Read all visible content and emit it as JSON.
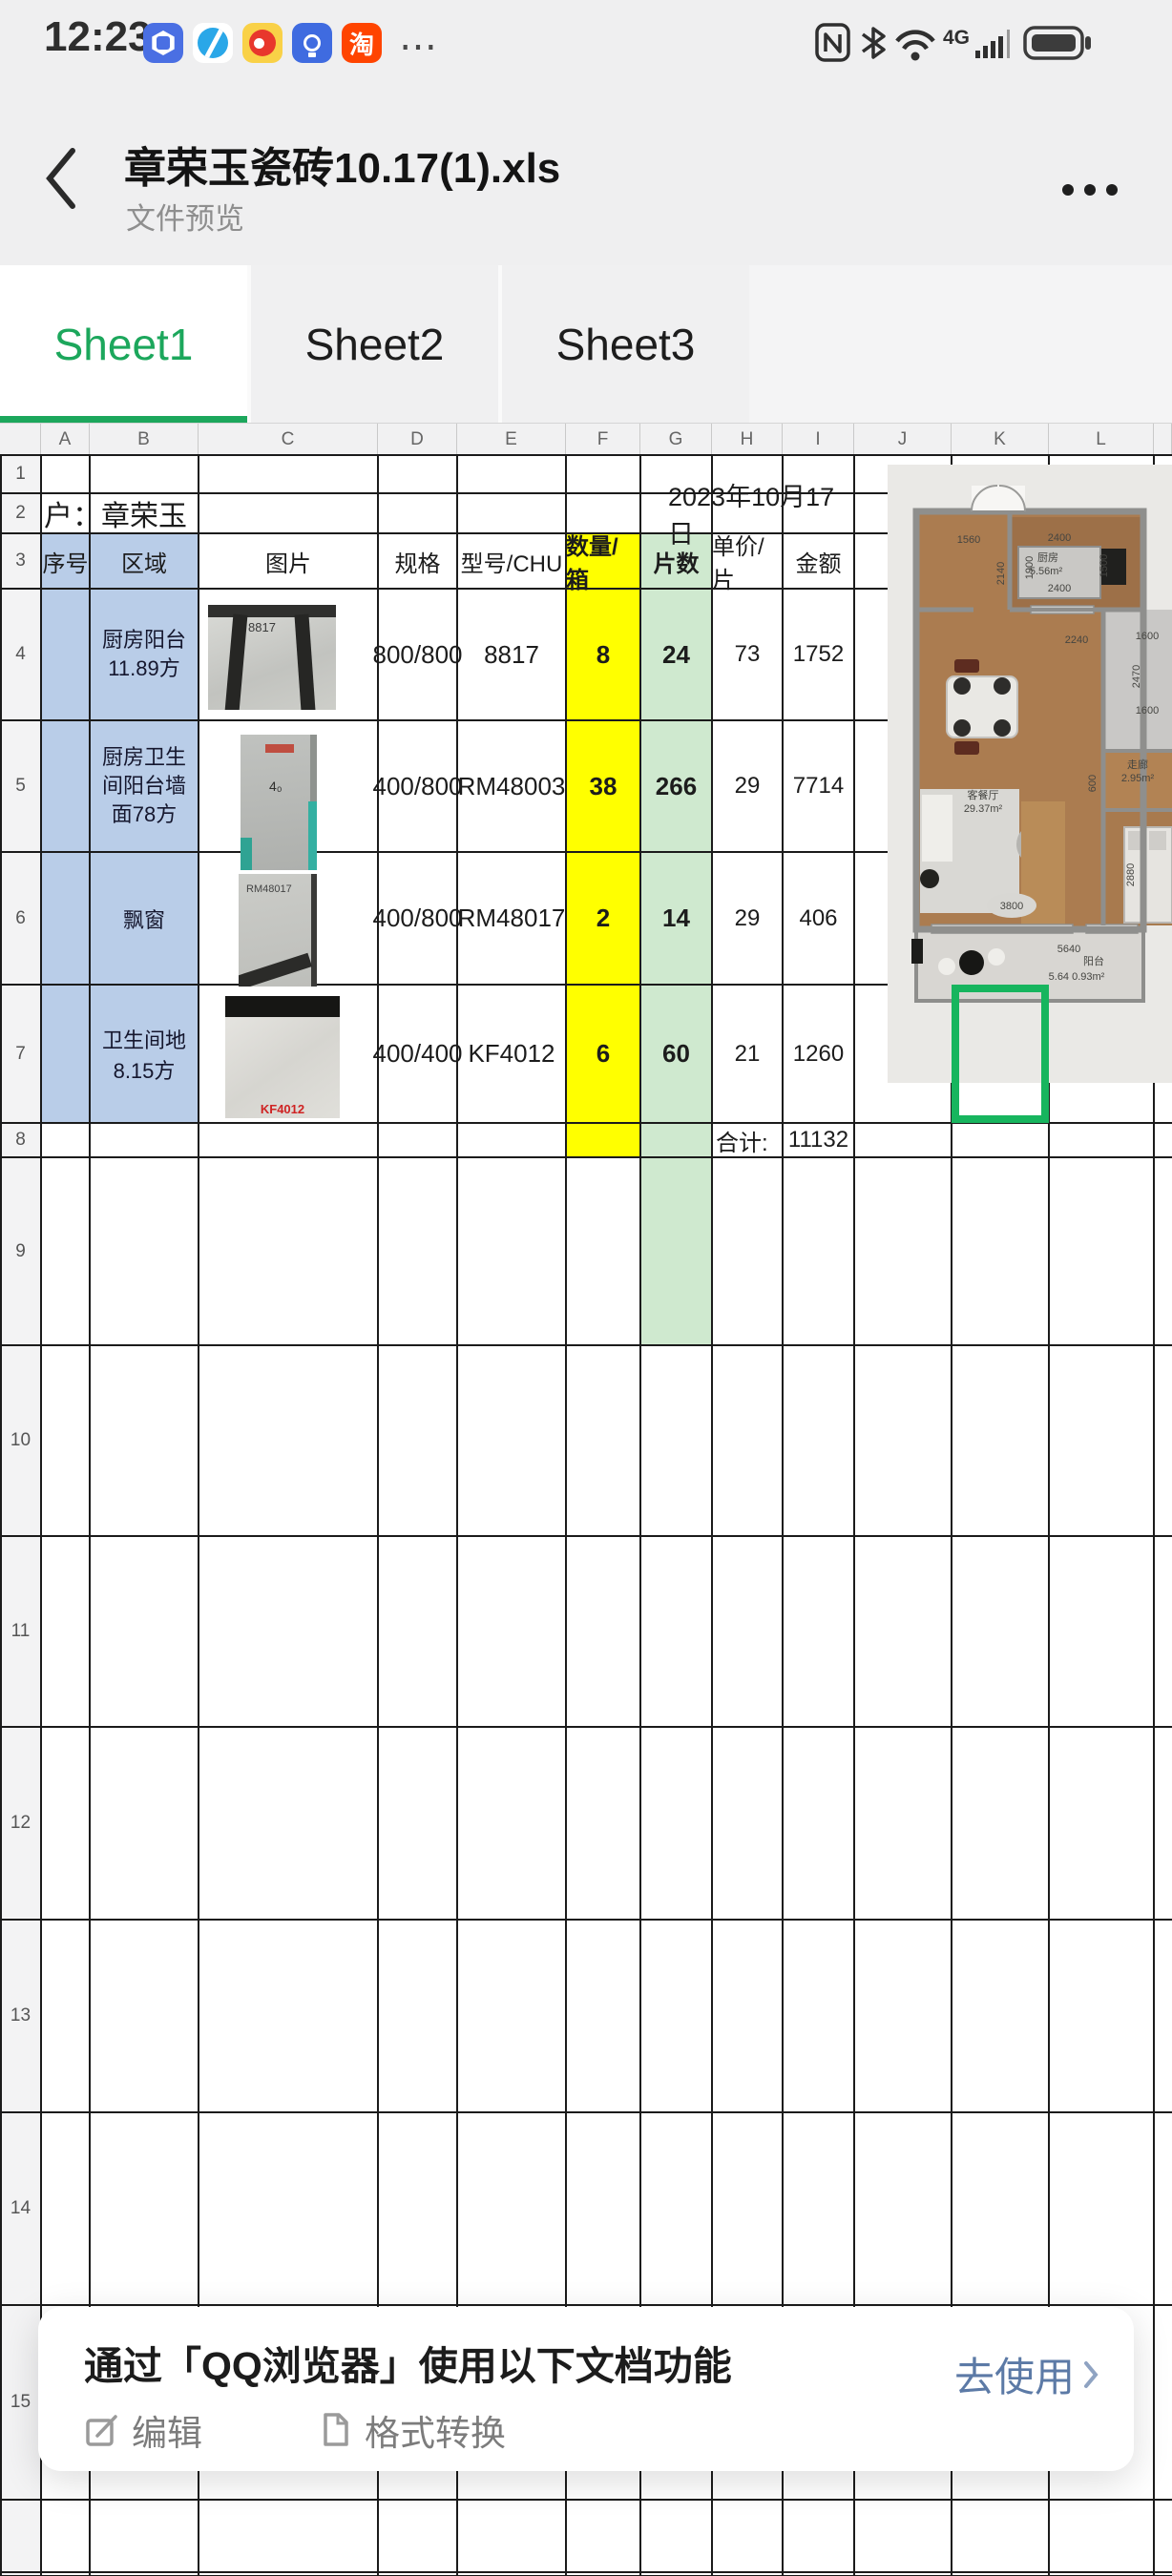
{
  "status_bar": {
    "time": "12:23",
    "more_indicator": "⋯",
    "icons": [
      "hand-app-icon",
      "globe-app-icon",
      "weibo-app-icon",
      "lightbulb-app-icon",
      "taobao-app-icon"
    ],
    "taobao_char": "淘",
    "network_label": "4G"
  },
  "nav": {
    "title": "章荣玉瓷砖10.17(1).xls",
    "subtitle": "文件预览"
  },
  "tabs": [
    {
      "label": "Sheet1",
      "active": true
    },
    {
      "label": "Sheet2",
      "active": false
    },
    {
      "label": "Sheet3",
      "active": false
    }
  ],
  "sheet": {
    "columns": [
      "A",
      "B",
      "C",
      "D",
      "E",
      "F",
      "G",
      "H",
      "I",
      "J",
      "K",
      "L"
    ],
    "row_numbers": [
      "1",
      "2",
      "3",
      "4",
      "5",
      "6",
      "7",
      "8",
      "9",
      "10",
      "11",
      "12",
      "13",
      "14",
      "15"
    ],
    "customer": "户：章荣玉",
    "date": "2023年10月17日",
    "header": {
      "seq": "序号",
      "area": "区域",
      "image": "图片",
      "spec": "规格",
      "model": "型号/CHU",
      "boxes": "数量/箱",
      "pieces": "片数",
      "unit_price": "单价/片",
      "amount": "金额"
    },
    "rows": [
      {
        "area": "厨房阳台11.89方",
        "spec": "800/800",
        "model": "8817",
        "boxes": "8",
        "pieces": "24",
        "unit_price": "73",
        "amount": "1752",
        "image_label": "8817"
      },
      {
        "area": "厨房卫生间阳台墙面78方",
        "spec": "400/800",
        "model": "RM48003",
        "boxes": "38",
        "pieces": "266",
        "unit_price": "29",
        "amount": "7714",
        "image_label": ""
      },
      {
        "area": "飘窗",
        "spec": "400/800",
        "model": "RM48017",
        "boxes": "2",
        "pieces": "14",
        "unit_price": "29",
        "amount": "406",
        "image_label": "RM48017"
      },
      {
        "area": "卫生间地8.15方",
        "spec": "400/400",
        "model": "KF4012",
        "boxes": "6",
        "pieces": "60",
        "unit_price": "21",
        "amount": "1260",
        "image_label": "KF4012"
      }
    ],
    "total_label": "合计:",
    "total_value": "11132",
    "colors": {
      "header_blue": "#b9cde8",
      "qty_yellow": "#ffff00",
      "pieces_green": "#cfe9cf",
      "selection_green": "#17b55e",
      "tab_green": "#1ca75c"
    }
  },
  "floorplan": {
    "labels": {
      "kitchen_name": "厨房",
      "kitchen_area": "5.56m²",
      "living_name": "客餐厅",
      "living_area": "29.37m²",
      "corridor_name": "走廊",
      "corridor_area": "2.95m²",
      "balcony_name": "阳台",
      "balcony_area": "5.64 0.93m²",
      "dim_1560": "1560",
      "dim_2400_top": "2400",
      "dim_2400_bottom": "2400",
      "dim_1900": "1900",
      "dim_1500": "1500",
      "dim_2140": "2140",
      "dim_2240": "2240",
      "dim_1600_top": "1600",
      "dim_2470": "2470",
      "dim_1600_bottom": "1600",
      "dim_3800": "3800",
      "dim_600": "600",
      "dim_2880": "2880",
      "dim_5640": "5640"
    }
  },
  "banner": {
    "title": "通过「QQ浏览器」使用以下文档功能",
    "cta": "去使用",
    "actions": [
      {
        "label": "编辑"
      },
      {
        "label": "格式转换"
      }
    ]
  }
}
